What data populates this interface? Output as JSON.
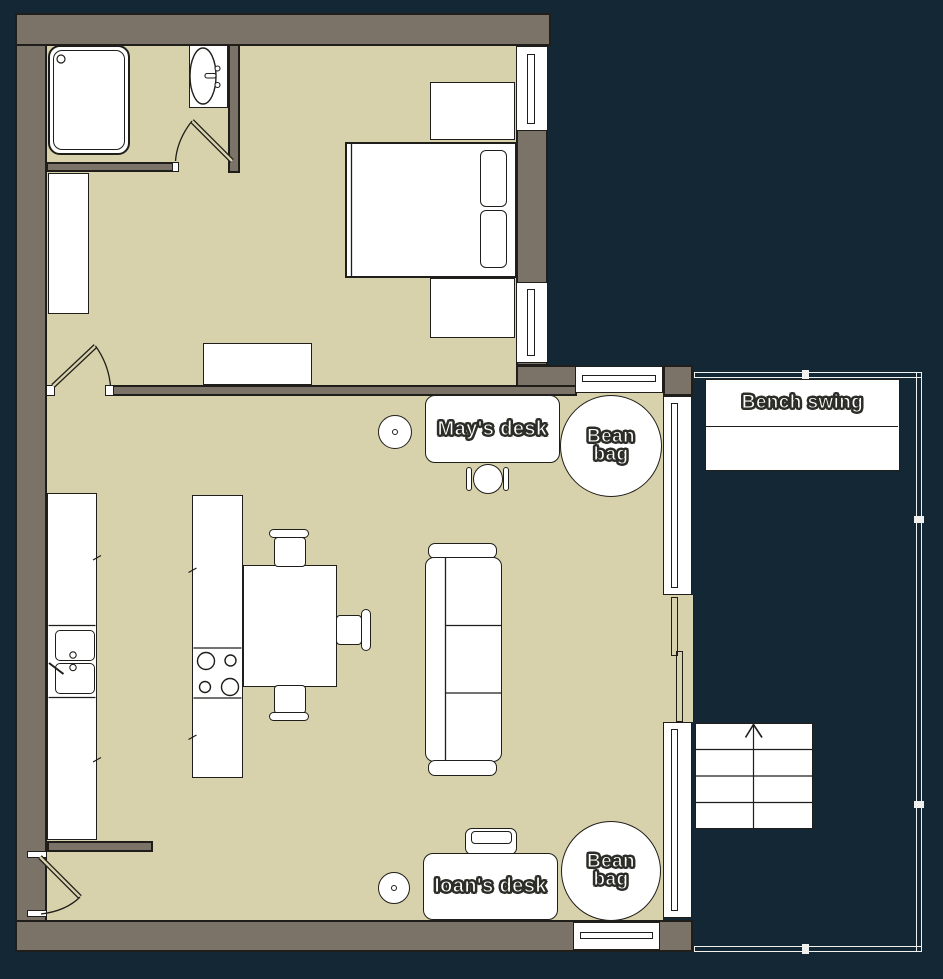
{
  "colors": {
    "background": "#132834",
    "floor": "#d7d2ab",
    "wall": "#7b7268",
    "outline": "#1f1e1a",
    "deck_rail": "#f0f0ee",
    "label_fill": "#ffffff",
    "label_outline": "#2d2d28"
  },
  "labels": {
    "mays_desk": "May's desk",
    "ioans_desk": "Ioan's desk",
    "bean_bag": {
      "line1": "Bean",
      "line2": "bag"
    },
    "bench_swing": "Bench swing"
  }
}
